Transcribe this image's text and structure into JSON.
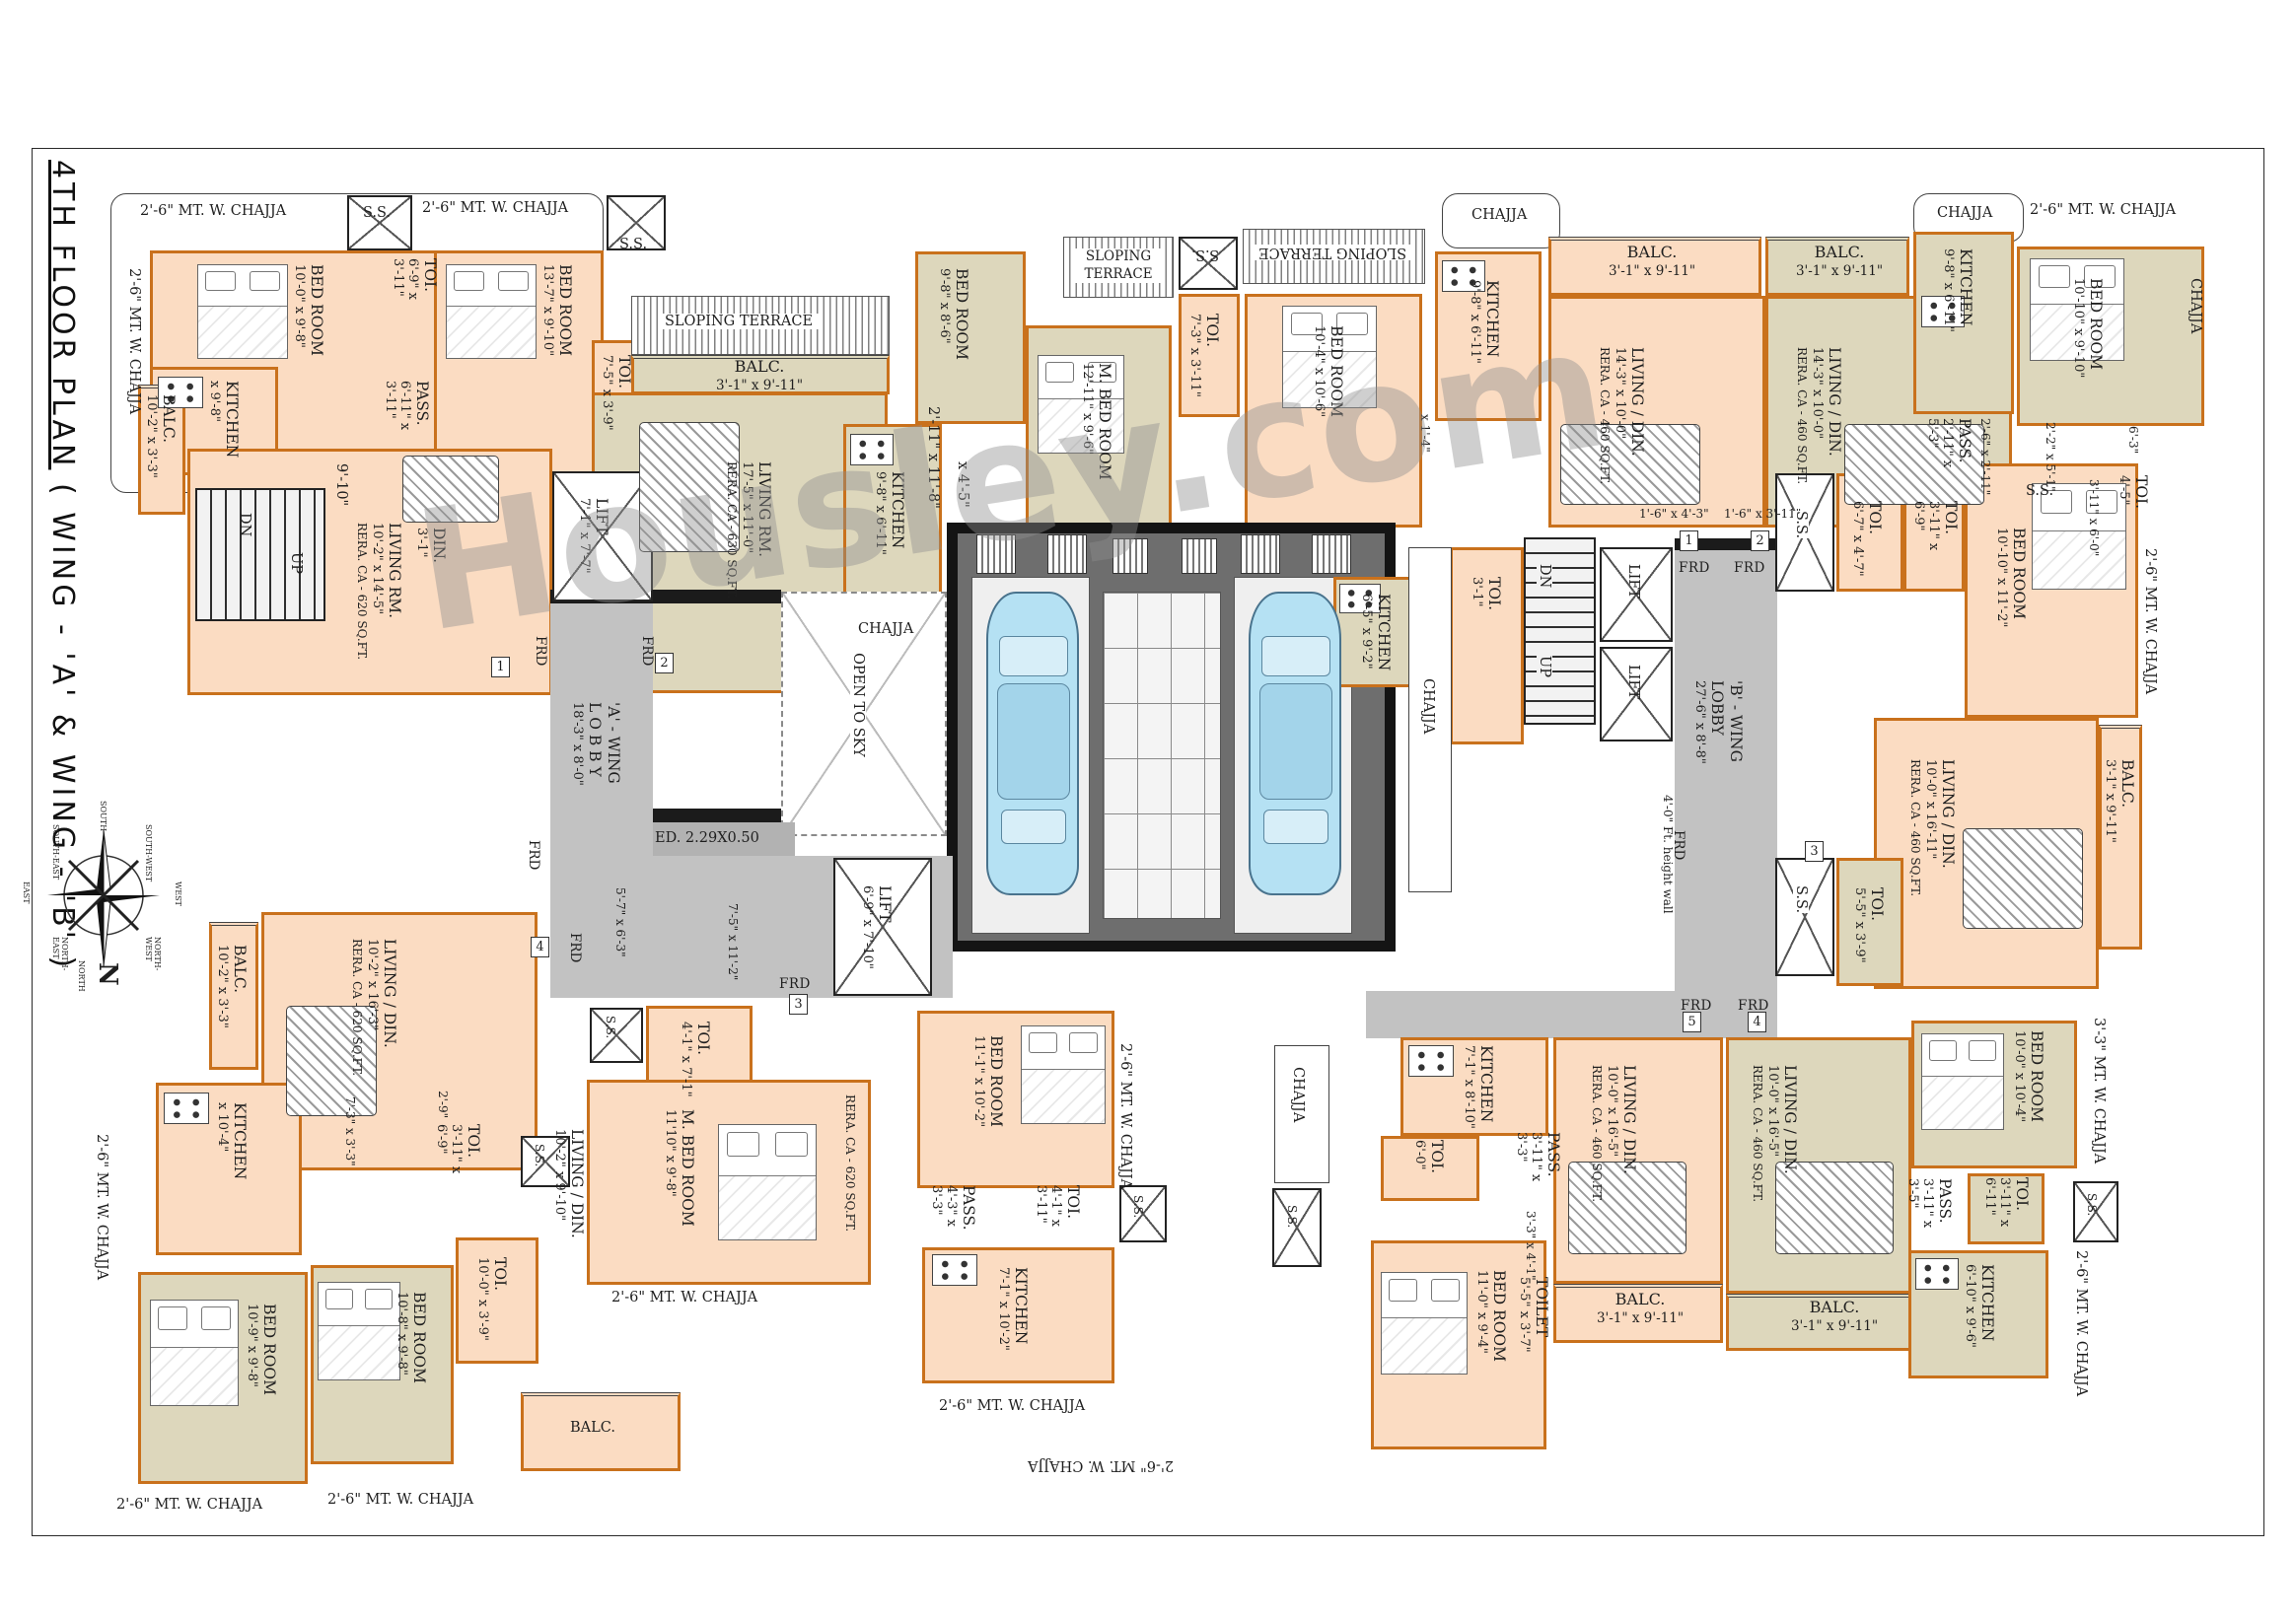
{
  "title": {
    "part1": "4TH  FLOOR PLAN",
    "part2": " ( WING - 'A' & WING - 'B' )"
  },
  "watermark": "Housley.com",
  "compass": {
    "n": "N",
    "points": [
      "SOUTH",
      "SOUTH-EAST",
      "EAST",
      "NORTH-EAST",
      "NORTH",
      "NORTH-WEST",
      "WEST",
      "SOUTH-WEST"
    ]
  },
  "units_a": [
    "1",
    "2",
    "3",
    "4"
  ],
  "units_b": [
    "1",
    "2",
    "3",
    "4",
    "5"
  ],
  "labels": {
    "chajja_26": "2'-6\" MT. W. CHAJJA",
    "chajja_33": "3'-3\" MT. W. CHAJJA",
    "chajja": "CHAJJA",
    "sloping_terrace": "SLOPING TERRACE",
    "sloping": "SLOPING",
    "terrace": "TERRACE",
    "ss": "S.S.",
    "frd": "FRD",
    "dn": "DN",
    "up": "UP",
    "open_to_sky": "OPEN TO SKY",
    "ed": "ED. 2.29X0.50",
    "height_wall": "4'-0\" Ft. height wall",
    "balc": "BALC.",
    "balc_dim": "3'-1\" x 9'-11\"",
    "a_lobby": [
      "'A' - WING",
      "L O B B Y",
      "18'-3\" x 8'-0\""
    ],
    "b_lobby": [
      "'B' - WING",
      "LOBBY",
      "27'-6\" x 8'-8\""
    ],
    "lift1": [
      "LIFT",
      "7'-1\" x 7'-7\""
    ],
    "lift2": [
      "LIFT",
      "6'-9\" x 7'-10\""
    ],
    "lift": "LIFT",
    "a_dim1": "5'-7\" x 6'-3\"",
    "a_dim2": "7'-5\" x 11'-2\"",
    "pass_dim1": "1'-6\" x 4'-3\"",
    "pass_dim2": "1'-6\" x 3'-11\"",
    "a1_bed1": [
      "BED ROOM",
      "10'-0\" x 9'-8\""
    ],
    "a1_toi": [
      "TOI.",
      "6'-9\" x 3'-11\""
    ],
    "a1_pass": [
      "PASS.",
      "6'-11\" x 3'-11\""
    ],
    "a1_bed2": [
      "BED ROOM",
      "13'-7\" x 9'-10\""
    ],
    "a1_kitchen": [
      "KITCHEN",
      "x 9'-8\""
    ],
    "a1_din": [
      "DIN.",
      "3'-1\""
    ],
    "a1_din_dim": "9'-10\"",
    "a1_living": [
      "LIVING RM.",
      "10'-2\" x 14'-5\"",
      "RERA. CA - 620 SQ.FT."
    ],
    "a1_balc": [
      "BALC.",
      "10'-2\" x 3'-3\""
    ],
    "a2_toi_a": [
      "TOI.",
      "7'-5\" x 3'-9\""
    ],
    "a2_living": [
      "LIVING RM.",
      "17'-5\" x 11'-0\"",
      "RERA. CA - 630 SQ.FT."
    ],
    "a2_kitchen": [
      "KITCHEN",
      "9'-8\" x 6'-11\""
    ],
    "a2_dim1": "2'-11\" x 11'-8\"",
    "a2_dim2": "x 4'-5\"",
    "a2_bed_top": [
      "BED ROOM",
      "9'-8\" x 8'-6\""
    ],
    "a2_mbed": [
      "M. BED ROOM",
      "12'-11\" x 9'-6\""
    ],
    "a2_toi_b": [
      "TOI.",
      "7'-3\" x 3'-11\""
    ],
    "a2_bed": [
      "BED ROOM",
      "10'-4\" x 10'-6\""
    ],
    "a2_dim3": "x 1'-4\"",
    "b1_kitchen": [
      "KITCHEN",
      "9'-8\" x 6'-11\""
    ],
    "b1_living": [
      "LIVING / DIN.",
      "14'-3\" x 10'-0\"",
      "RERA. CA - 460 SQ.FT."
    ],
    "b2_living": [
      "LIVING / DIN.",
      "14'-3\" x 10'-0\"",
      "RERA. CA - 460 SQ.FT."
    ],
    "b2_kitchen": [
      "KITCHEN",
      "9'-8\" x 6'-11\""
    ],
    "b2_bed": [
      "BED ROOM",
      "10'-10\" x 9'-10\""
    ],
    "b2_pass": [
      "PASS.",
      "2'-11\" x 5'-3\""
    ],
    "b2_dim1": "2'-6\" x 2'-11\"",
    "b2_dim2": "2'-2\" x 5'-1\"",
    "b2_dim3": "6'-3\"",
    "b2_toi": [
      "TOI.",
      "4'-5\""
    ],
    "b2_toi_dim": "3'-11\" x 6'-0\"",
    "b3_toi1": [
      "TOI.",
      "3'-11\" x 6'-9\""
    ],
    "b3_toi2": [
      "TOI.",
      "6'-7\" x 4'-7\""
    ],
    "b3_bed": [
      "BED ROOM",
      "10'-10\" x 11'-2\""
    ],
    "b3_living": [
      "LIVING / DIN.",
      "10'-0\" x 16'-11\"",
      "RERA. CA - 460 SQ.FT."
    ],
    "b3_toi3": [
      "TOI.",
      "5'-5\" x 3'-9\""
    ],
    "b3_kitchen": [
      "KITCHEN",
      "6'-5\" x 9'-2\""
    ],
    "b_toi_small": [
      "TOI.",
      "3'-1\""
    ],
    "a4_balc": [
      "BALC.",
      "10'-2\" x 3'-3\""
    ],
    "a4_living": [
      "LIVING / DIN.",
      "10'-2\" x 16'-3\"",
      "RERA. CA - 620 SQ.FT."
    ],
    "a4_kitchen": [
      "KITCHEN",
      "x 10'-4\""
    ],
    "a4_pass_dim": "7'-3\" x 3'-3\"",
    "a4_dim29": "2'-9\"",
    "a4_toi1": [
      "TOI.",
      "3'-11\" x 6'-9\""
    ],
    "a4_bed1": [
      "BED ROOM",
      "10'-9\" x 9'-8\""
    ],
    "a4_bed2": [
      "BED ROOM",
      "10'-8\" x 9'-8\""
    ],
    "a4_toi2": [
      "TOI.",
      "10'-0\" x 3'-9\""
    ],
    "a3_toi1": [
      "TOI.",
      "4'-1\" x 7'-1\""
    ],
    "a3_mbed": [
      "M. BED ROOM",
      "11'10\" x 9'-8\""
    ],
    "a3_rera": "RERA. CA - 620 SQ.FT.",
    "a3_living": [
      "LIVING / DIN.",
      "10'-2\" x 9'-10\""
    ],
    "a3_bed": [
      "BED ROOM",
      "11'-1\" x 10'-2\""
    ],
    "a3_pass": [
      "PASS.",
      "4'-3\" x 3'-3\""
    ],
    "a3_toi2": [
      "TOI.",
      "4'-1\" x 3'-11\""
    ],
    "a3_kitchen": [
      "KITCHEN",
      "7'-1\" x 10'-2\""
    ],
    "b5_kitchen": [
      "KITCHEN",
      "7'-1\" x 8'-10\""
    ],
    "b5_toi": [
      "TOI.",
      "6'-0\""
    ],
    "b5_pass": [
      "PASS.",
      "3'-11\" x 3'-3\""
    ],
    "b5_dim": "3'-3\" x 4'-1\"",
    "b5_bed": [
      "BED ROOM",
      "11'-0\" x 9'-4\""
    ],
    "b5_toilet": [
      "TOILET",
      "5'-5\" x 3'-7\""
    ],
    "b5_living": [
      "LIVING / DIN.",
      "10'-0\" x 16'-5\"",
      "RERA. CA - 460 SQ.FT."
    ],
    "b4_living": [
      "LIVING / DIN.",
      "10'-0\" x 16'-5\"",
      "RERA. CA - 460 SQ.FT."
    ],
    "b4_bed": [
      "BED ROOM",
      "10'-0\" x 10'-4\""
    ],
    "b4_pass": [
      "PASS.",
      "3'-11\" x 3'-5\""
    ],
    "b4_toi": [
      "TOI.",
      "3'-11\" x 6'-11\""
    ],
    "b4_kitchen": [
      "KITCHEN",
      "6'-10\" x 9'-6\""
    ]
  }
}
